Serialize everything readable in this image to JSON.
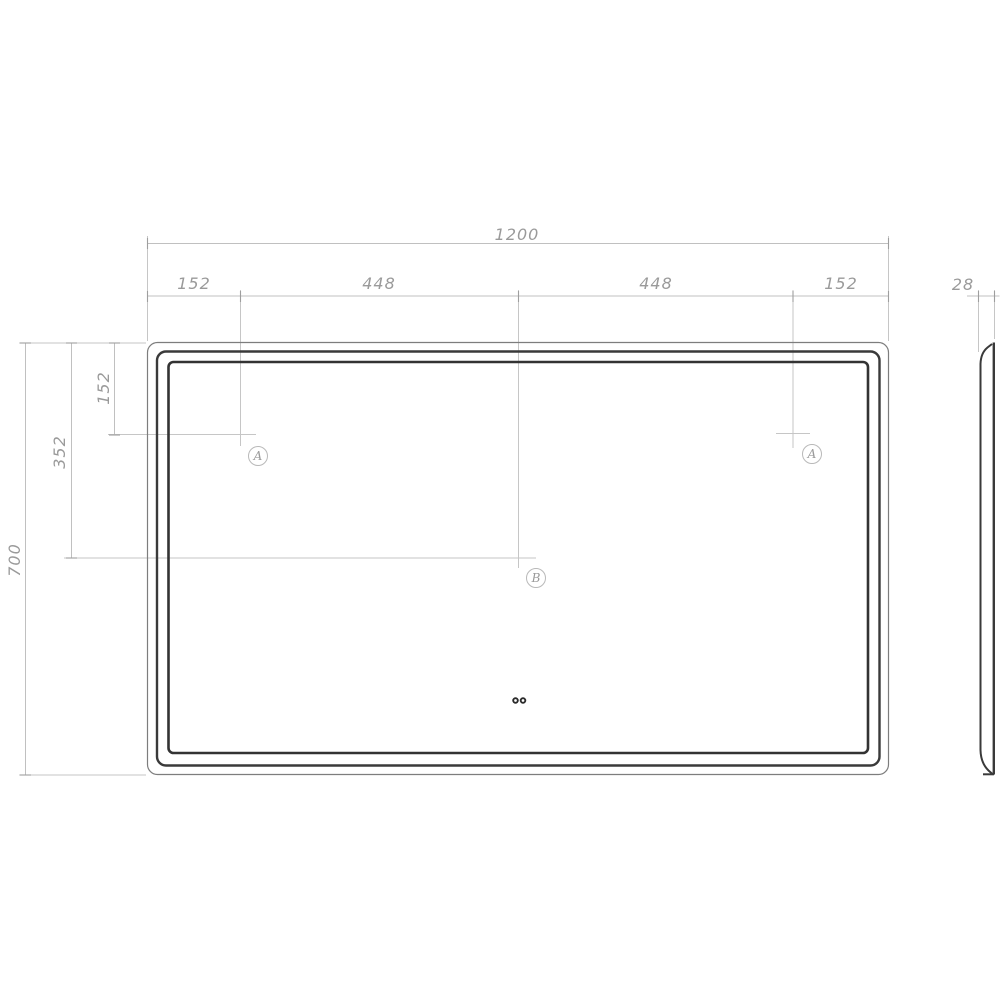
{
  "drawing": {
    "type": "technical-dimension-drawing",
    "views": {
      "front": "mirror panel front view with three nested rounded outlines and two touch-sensor dots",
      "side": "thin side profile at right"
    },
    "dimensions": {
      "top": {
        "total_width": "1200",
        "segments": [
          "152",
          "448",
          "448",
          "152"
        ]
      },
      "side": {
        "depth": "28"
      },
      "left": {
        "offset_top": "152",
        "offset_center": "352",
        "total_height": "700"
      }
    },
    "point_labels": {
      "a_left": "A",
      "b_center": "B",
      "a_right": "A"
    },
    "colors": {
      "background": "#ffffff",
      "outline_dark": "#3a3a3a",
      "outline_thin": "#7d7d7d",
      "dim_line": "#c4c4c4",
      "tick": "#9e9e9e",
      "dim_text": "#9a9a9a",
      "dot": "#2b2b2b"
    }
  }
}
